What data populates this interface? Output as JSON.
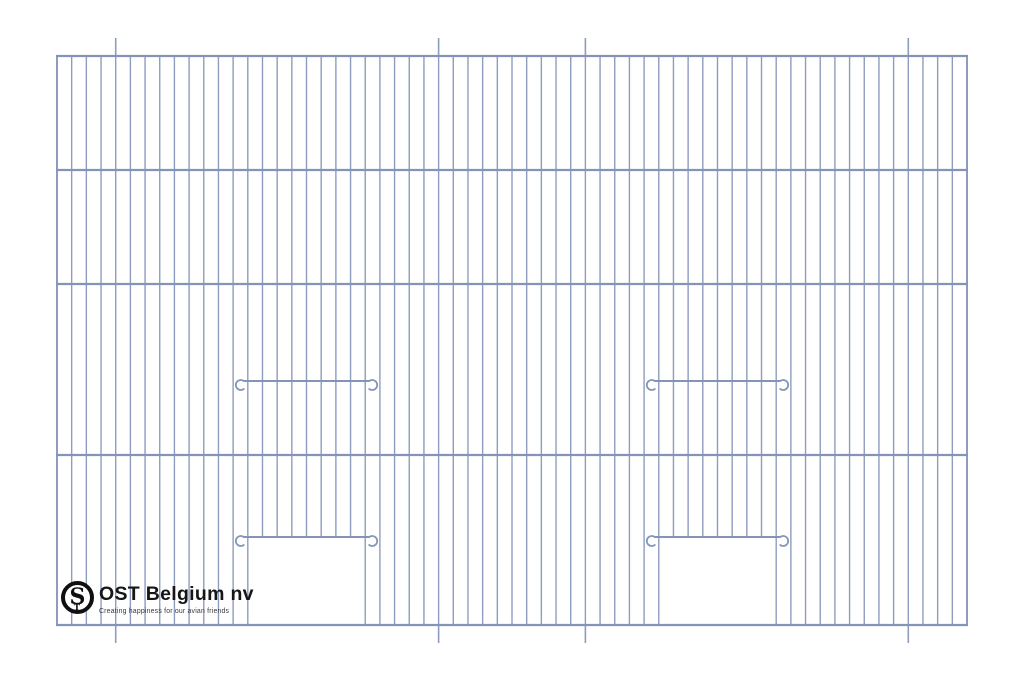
{
  "logo": {
    "company_name": "OST Belgium nv",
    "tagline": "Creating happiness for our avian friends",
    "monogram": {
      "large_letter": "S",
      "small_letter": "T"
    }
  },
  "drawing": {
    "background_color": "#ffffff",
    "wire_color": "#8e9dbe",
    "rail_color": "#8494b8",
    "frame": {
      "left": 57,
      "right": 967,
      "top": 56,
      "bottom": 625
    },
    "horizontal_rails_y": [
      56,
      170,
      284,
      455,
      625
    ],
    "vertical_wire_count": 63,
    "section_mark_wire_indices": [
      4,
      26,
      36,
      58
    ],
    "section_mark_length": 18,
    "hook_radius": 5,
    "doors": [
      {
        "left_wire_index": 13,
        "right_wire_index": 21,
        "slide_bar_y": 381,
        "opening_top_y": 537
      },
      {
        "left_wire_index": 41,
        "right_wire_index": 49,
        "slide_bar_y": 381,
        "opening_top_y": 537
      }
    ]
  }
}
